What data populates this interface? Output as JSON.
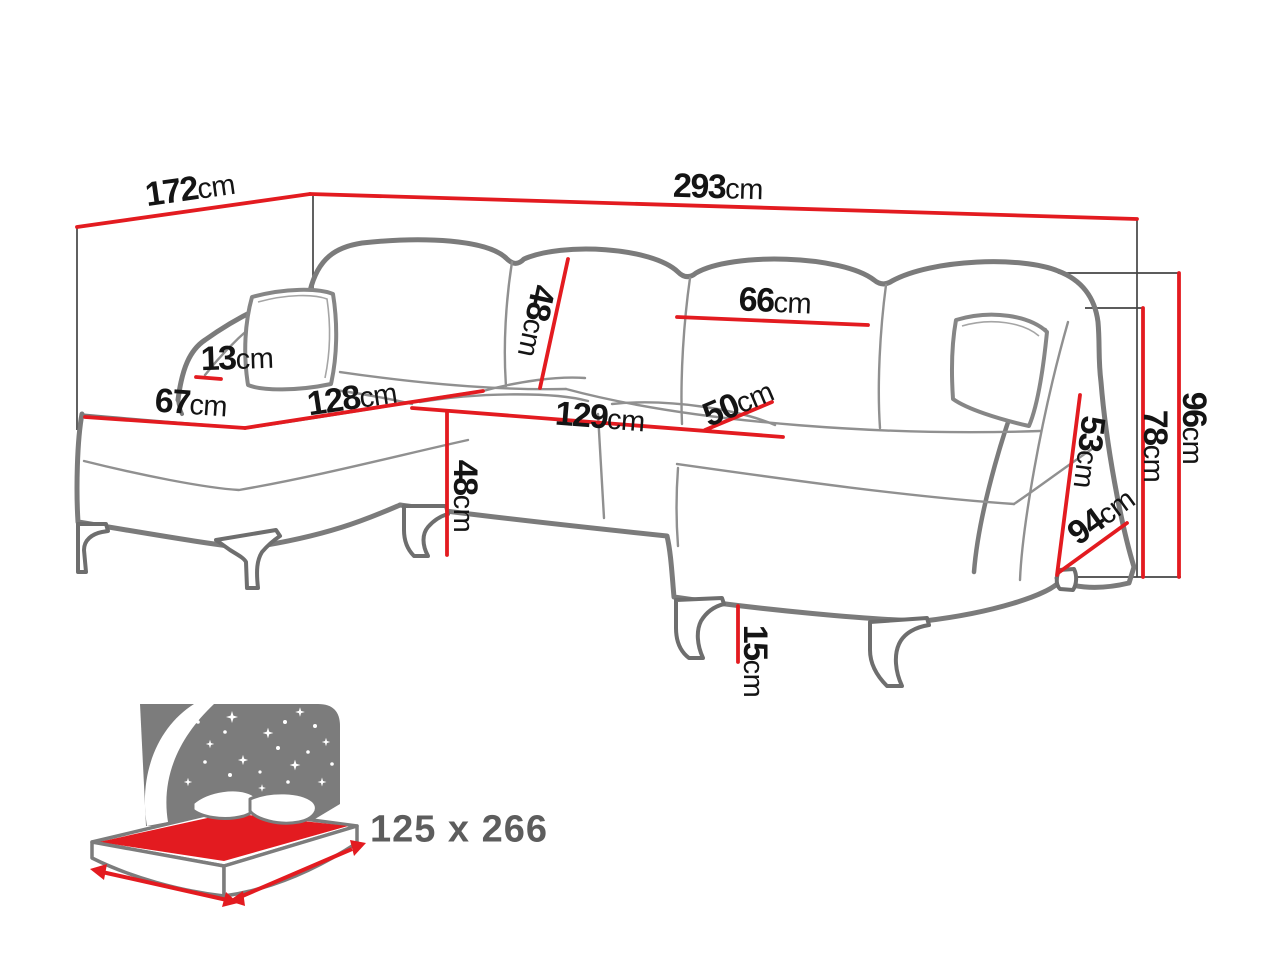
{
  "unit": "cm",
  "dims": {
    "left_depth": "172",
    "total_width": "293",
    "back_cushion_width": "66",
    "back_cushion_height": "48",
    "left_arm_height": "13",
    "left_chaise_width": "67",
    "left_chaise_length": "128",
    "middle_seat_width": "129",
    "right_seat_depth": "50",
    "seat_height": "48",
    "leg_height": "15",
    "armrest_inner_height": "53",
    "right_depth": "94",
    "armrest_height": "78",
    "total_height": "96"
  },
  "sleeping_area": "125 x 266",
  "colors": {
    "measure_red": "#e31b20",
    "sofa_outline": "#7b7b7b",
    "helper_line": "#454545",
    "label_text": "#141414",
    "icon_gray": "#7c7c7c",
    "bed_text": "#5d5d5d"
  }
}
